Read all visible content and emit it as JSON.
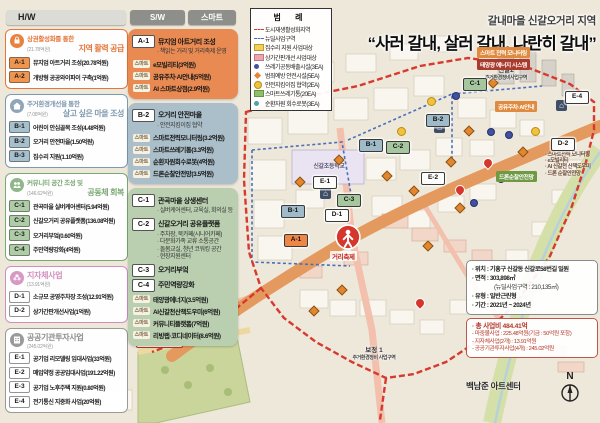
{
  "toolbar": {
    "hw": "H/W",
    "sw": "S/W",
    "smart": "스마트"
  },
  "title": {
    "region": "갈내마을 신갈오거리 지역",
    "slogan": "“사러 갈내, 살러 갈내, 나란히 갈내”"
  },
  "hw_panel": {
    "sections": [
      {
        "type": "A",
        "icon": "shopping-bag-icon",
        "title": "상권활성화를 통한",
        "budget": "(21.78억원)",
        "subtitle": "지역 활력 공급",
        "items": [
          {
            "code": "A-1",
            "label": "뮤지엄 아트거리 조성(20.78억원)"
          },
          {
            "code": "A-2",
            "label": "개방형 공공와이파이 구축(1억원)"
          }
        ]
      },
      {
        "type": "B",
        "icon": "house-icon",
        "title": "주거환경개선을 통한",
        "budget": "(7.08억원)",
        "subtitle": "살고 싶은 마을 조성",
        "items": [
          {
            "code": "B-1",
            "label": "어린이 안심골목 조성(4.48억원)"
          },
          {
            "code": "B-2",
            "label": "오거리 안전마을(1.50억원)"
          },
          {
            "code": "B-3",
            "label": "집수리 지원(1.10억원)"
          }
        ]
      },
      {
        "type": "C",
        "icon": "community-icon",
        "title": "커뮤니티 공간 조성 및",
        "budget": "(146.62억원)",
        "subtitle": "공동체 회복",
        "items": [
          {
            "code": "C-1",
            "label": "관곡마을 실버케어센터(5.94억원)"
          },
          {
            "code": "C-2",
            "label": "신갈오거리 공유플랫폼(136.08억원)"
          },
          {
            "code": "C-3",
            "label": "오거리부엌(0.60억원)"
          },
          {
            "code": "C-4",
            "label": "주민역량강화(4억원)"
          }
        ]
      },
      {
        "type": "D",
        "icon": "flower-icon",
        "title": "지자체사업",
        "budget": "(13.91억원)",
        "subtitle": "",
        "items": [
          {
            "code": "D-1",
            "label": "소규모 공영주차장 조성(12.91억원)"
          },
          {
            "code": "D-2",
            "label": "상가간판개선사업(1억원)"
          }
        ]
      },
      {
        "type": "E",
        "icon": "public-building-icon",
        "title": "공공기관투자사업",
        "budget": "(245.02억원)",
        "subtitle": "",
        "items": [
          {
            "code": "E-1",
            "label": "공기업 리모델링 임대사업(33억원)"
          },
          {
            "code": "E-2",
            "label": "매입약정 공공임대사업(191.22억원)"
          },
          {
            "code": "E-3",
            "label": "공기업 노후주택 지원(0.80억원)"
          },
          {
            "code": "E-4",
            "label": "전기통신 지중화 사업(20억원)"
          }
        ]
      }
    ]
  },
  "sw_panel": {
    "smart_chip": "스마트",
    "boxes": [
      {
        "type": "A",
        "entries": [
          {
            "kind": "head",
            "code": "A-1",
            "label": "뮤지엄 아트거리 조성"
          },
          {
            "kind": "sub",
            "text": "· 책읽는 거리 및 거리축제 운영"
          },
          {
            "kind": "smart",
            "label": "e모빌리티(3억원)"
          },
          {
            "kind": "smart",
            "label": "공유주차·AI안내(5억원)"
          },
          {
            "kind": "smart",
            "label": "AI 스마트상점(2.9억원)"
          }
        ]
      },
      {
        "type": "B",
        "entries": [
          {
            "kind": "head",
            "code": "B-2",
            "label": "오거리 안전마을"
          },
          {
            "kind": "sub",
            "text": "· 안전지킴이집 협약"
          },
          {
            "kind": "smart",
            "label": "스마트전력모니터링(3.2억원)"
          },
          {
            "kind": "smart",
            "label": "스마트쓰레기통(3.3억원)"
          },
          {
            "kind": "smart",
            "label": "순환자원회수로봇(4억원)"
          },
          {
            "kind": "smart",
            "label": "드론순찰안전망(3.5억원)"
          }
        ]
      },
      {
        "type": "C",
        "entries": [
          {
            "kind": "head",
            "code": "C-1",
            "label": "관곡마을 상생센터"
          },
          {
            "kind": "sub",
            "text": "· 실버케어센터, 교육실, 회의실 등"
          },
          {
            "kind": "head",
            "code": "C-2",
            "label": "신갈오거리 공유플랫폼"
          },
          {
            "kind": "sub",
            "text": "· 주차장, 북카페(시니어카페)"
          },
          {
            "kind": "sub",
            "text": "· 다문화가족 교류 소통공간"
          },
          {
            "kind": "sub",
            "text": "· 돌봄교실, 청년 코워킹 공간"
          },
          {
            "kind": "sub",
            "text": "· 현장지원센터"
          },
          {
            "kind": "head",
            "code": "C-3",
            "label": "오거리부엌"
          },
          {
            "kind": "head",
            "code": "C-4",
            "label": "주민역량강화"
          },
          {
            "kind": "smart",
            "label": "태양광에너지(3.5억원)"
          },
          {
            "kind": "smart",
            "label": "AI신갈천산책도우미(6억원)"
          },
          {
            "kind": "smart",
            "label": "커뮤니티플랫폼(7억원)"
          },
          {
            "kind": "smart",
            "label": "리빙랩·코디네이터(8.6억원)"
          }
        ]
      }
    ]
  },
  "legend": {
    "title": "범 례",
    "items": [
      {
        "swatch": "line-red",
        "label": "도시재생활성화지역"
      },
      {
        "swatch": "line-blue",
        "label": "뉴딜사업구역"
      },
      {
        "swatch": "fill-yellow",
        "label": "집수리 지원 사업대상"
      },
      {
        "swatch": "fill-pink",
        "label": "상가간판개선 사업대상"
      },
      {
        "swatch": "dot-blue",
        "label": "쓰레기공동배출시설(3EA)"
      },
      {
        "swatch": "diamond",
        "label": "범죄예방 안전시설(5EA)"
      },
      {
        "swatch": "dot-yellow",
        "label": "안전지킴이집 협약(2EA)"
      },
      {
        "swatch": "fill-green",
        "label": "스마트쓰레기통(20EA)"
      },
      {
        "swatch": "dot-teal",
        "label": "순환자원 회수로봇(3EA)"
      }
    ]
  },
  "info": {
    "lines": [
      "· 위치 : 기흥구 신갈동 신갈로58번길 일원",
      "· 면적 : 303,898㎡",
      "(뉴딜사업구역 : 210,135㎡)",
      "· 유형 : 일반근린형",
      "· 기간 : 2021년 ~ 2024년"
    ],
    "budget_title": "· 총 사업비 484.41억",
    "budget_lines": [
      "- 마중물사업 : 225.48억원(기금 : 50억원 포함)",
      "- 지자체사업(2개) : 13.91억원",
      "- 공공기관투자사업(4개) : 245.02억원"
    ]
  },
  "map": {
    "school_label": "신갈초등학교",
    "festival_label": "거리축제",
    "landmark_label": "백남준 아트센터",
    "compass_label": "N",
    "area_labels": [
      {
        "line1": "신갈2",
        "line2": "주거환경정비사업구역",
        "x": 470,
        "y": 64
      },
      {
        "line1": "보정 1",
        "line2": "주거환경정비 사업구역",
        "x": 338,
        "y": 344
      }
    ],
    "parking_callout": {
      "x": 136,
      "y": 322,
      "lines": [
        "주차환경개선사업",
        "(주차장280면 조성)",
        "2020년 준공예정"
      ]
    },
    "callouts": [
      {
        "x": 477,
        "y": 47,
        "lines": [
          {
            "text": "스마트 전력 모니터링",
            "bg": "#df8a3e"
          },
          {
            "text": "태양광 에너지 시스템",
            "bg": "#a93a2c"
          }
        ]
      },
      {
        "x": 495,
        "y": 101,
        "lines": [
          {
            "text": "공유주차·AI안내",
            "bg": "#df8a3e"
          }
        ]
      },
      {
        "x": 496,
        "y": 171,
        "lines": [
          {
            "text": "드론순찰안전망",
            "bg": "#6f9a45"
          }
        ]
      }
    ],
    "smart_notes": {
      "x": 545,
      "y": 152,
      "lines": [
        "· 스마트전력 모니터링",
        "· e모빌리티",
        "· AI 신갈천 산책도우미",
        "· 드론 순찰안전망"
      ]
    },
    "badges": [
      {
        "code": "A-1",
        "type": "A",
        "x": 284,
        "y": 234
      },
      {
        "code": "B-1",
        "type": "B",
        "x": 359,
        "y": 139
      },
      {
        "code": "B-1",
        "type": "B",
        "x": 281,
        "y": 205
      },
      {
        "code": "B-2",
        "type": "B",
        "x": 426,
        "y": 114
      },
      {
        "code": "C-1",
        "type": "C",
        "x": 463,
        "y": 78
      },
      {
        "code": "C-2",
        "type": "C",
        "x": 386,
        "y": 141
      },
      {
        "code": "C-3",
        "type": "C",
        "x": 337,
        "y": 194
      },
      {
        "code": "D-1",
        "type": "D",
        "x": 325,
        "y": 209
      },
      {
        "code": "D-2",
        "type": "D",
        "x": 551,
        "y": 138
      },
      {
        "code": "E-1",
        "type": "E",
        "x": 313,
        "y": 176
      },
      {
        "code": "E-2",
        "type": "E",
        "x": 421,
        "y": 172
      },
      {
        "code": "E-4",
        "type": "E",
        "x": 565,
        "y": 91
      }
    ],
    "markers": [
      {
        "type": "safety-diamond",
        "x": 335,
        "y": 156
      },
      {
        "type": "safety-diamond",
        "x": 383,
        "y": 172
      },
      {
        "type": "safety-diamond",
        "x": 410,
        "y": 187
      },
      {
        "type": "safety-diamond",
        "x": 447,
        "y": 158
      },
      {
        "type": "safety-diamond",
        "x": 465,
        "y": 127
      },
      {
        "type": "safety-diamond",
        "x": 489,
        "y": 79
      },
      {
        "type": "safety-diamond",
        "x": 519,
        "y": 148
      },
      {
        "type": "safety-diamond",
        "x": 456,
        "y": 204
      },
      {
        "type": "safety-diamond",
        "x": 338,
        "y": 286
      },
      {
        "type": "safety-diamond",
        "x": 310,
        "y": 307
      },
      {
        "type": "safety-diamond",
        "x": 296,
        "y": 178
      },
      {
        "type": "safety-diamond",
        "x": 424,
        "y": 242
      },
      {
        "type": "trash-dot",
        "x": 452,
        "y": 92
      },
      {
        "type": "trash-dot",
        "x": 487,
        "y": 128
      },
      {
        "type": "trash-dot",
        "x": 505,
        "y": 131
      },
      {
        "type": "trash-dot",
        "x": 470,
        "y": 199
      },
      {
        "type": "trash-dot",
        "x": 497,
        "y": 175
      },
      {
        "type": "keeper-dot",
        "x": 397,
        "y": 127
      },
      {
        "type": "keeper-dot",
        "x": 531,
        "y": 127
      },
      {
        "type": "keeper-dot",
        "x": 427,
        "y": 97
      },
      {
        "type": "house-marker",
        "x": 320,
        "y": 188
      },
      {
        "type": "house-marker",
        "x": 556,
        "y": 100
      },
      {
        "type": "house-marker",
        "x": 434,
        "y": 122
      },
      {
        "type": "pin-red",
        "x": 483,
        "y": 158
      },
      {
        "type": "pin-red",
        "x": 455,
        "y": 185
      },
      {
        "type": "pin-red",
        "x": 415,
        "y": 298
      }
    ]
  },
  "colors": {
    "commerce_accent": "#e4763b",
    "housing_accent": "#7e9ab0",
    "community_accent": "#79a873",
    "municipal_accent": "#cf8fbe",
    "agency_accent": "#8c8c8a",
    "road_main": "#e49a5e",
    "boundary_regeneration": "#d63a2e",
    "boundary_newdeal": "#4a6fba"
  }
}
